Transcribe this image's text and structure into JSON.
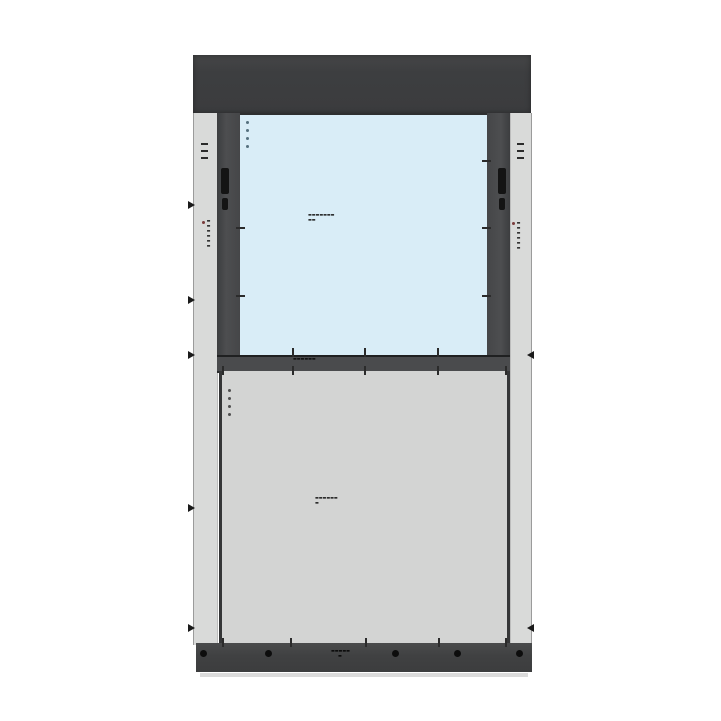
{
  "drawing": {
    "kind": "window-wall unit elevation",
    "colors": {
      "head_cap": "#3d3e40",
      "mullion": "#4a4b4d",
      "glass": "#d9edf7",
      "spandrel": "#d3d4d3",
      "jamb_strip": "#d9dad9",
      "base_sill": "#404142",
      "annotation": "#161616",
      "accent_dot": "#7a3b3b",
      "background": "#ffffff"
    },
    "labels": {
      "glass_mark": {
        "line1": "▬▬▬▬▬▬▬",
        "line2": "▬▬"
      },
      "transom_mark": {
        "line1": "▬▬▬▬▬▬"
      },
      "spandrel_mark": {
        "line1": "▬▬▬▬▬▬",
        "line2": "▬"
      },
      "sill_mark": {
        "line1": "▬▬▬▬▬",
        "line2": "▬"
      },
      "left_jamb_mark": "▬▬▬▬▬▬",
      "right_jamb_mark": "▬▬▬▬▬▬"
    },
    "hardware": {
      "bolt_count": 5
    }
  }
}
